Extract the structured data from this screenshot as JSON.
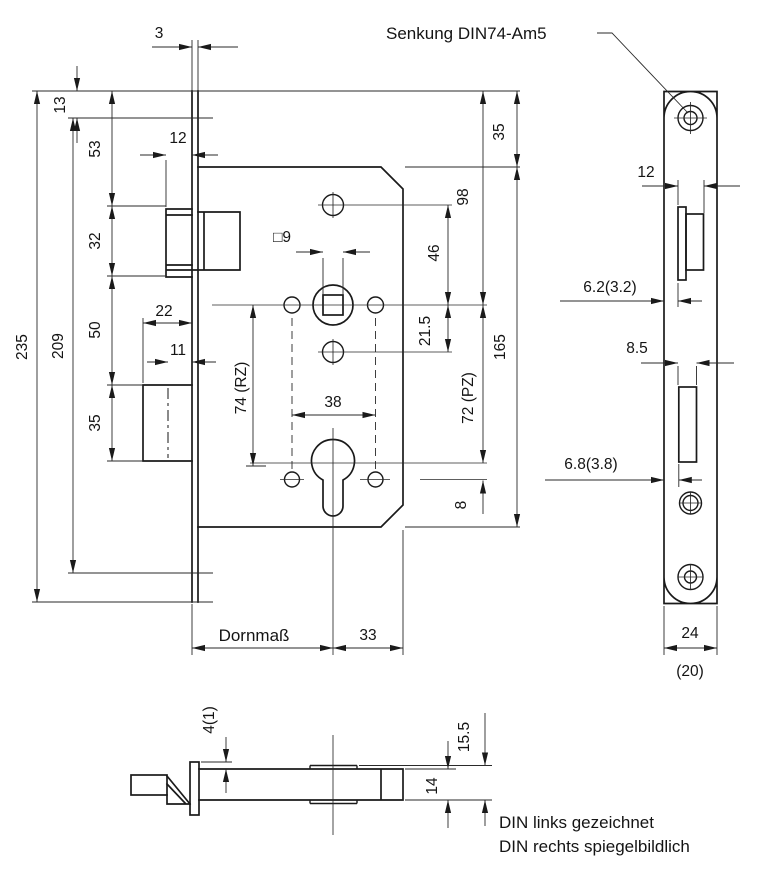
{
  "drawing_type": "mortise lock technical drawing",
  "colors": {
    "ink": "#1a1a1a",
    "background": "#ffffff"
  },
  "main": {
    "plate_thickness": "3",
    "callout_countersink": "Senkung DIN74-Am5",
    "hole_edge_offset": "13",
    "plate_to_latch": "53",
    "latch_height": "32",
    "latch_to_bolt": "50",
    "bolt_height": "35",
    "plate_length": "235",
    "hole_spacing": "209",
    "latch_protrusion": "12",
    "bolt_head_width": "22",
    "bolt_throw": "11",
    "spindle_square": "□9",
    "hub_screw_spacing": "38",
    "rz_distance": "74 (RZ)",
    "pz_distance": "72 (PZ)",
    "spindle_to_top_hole": "46",
    "spindle_to_lower_hole": "21.5",
    "plate_to_spindle": "98",
    "plate_to_case": "35",
    "case_height": "165",
    "cyl_to_screws": "8",
    "backset_label": "Dornmaß",
    "cyl_to_case_edge": "33"
  },
  "front": {
    "latch_width": "12",
    "latch_offset": "6.2(3.2)",
    "bolt_width": "8.5",
    "bolt_offset": "6.8(3.8)",
    "plate_width": "24",
    "plate_width_alt": "(20)"
  },
  "bottom": {
    "plate_lip": "4(1)",
    "overall_depth": "15.5",
    "case_depth": "14"
  },
  "notes": {
    "line1": "DIN links gezeichnet",
    "line2": "DIN rechts spiegelbildlich"
  }
}
